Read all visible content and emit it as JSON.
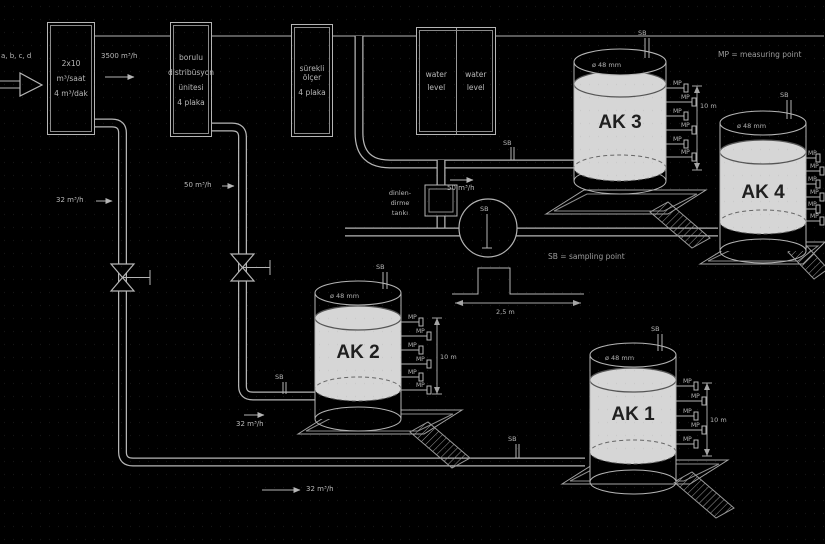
{
  "inlet": {
    "label": "a, b, c, d"
  },
  "process_boxes": {
    "box1": {
      "lines": [
        "2x10",
        "m³/saat",
        "4 m³/dak"
      ]
    },
    "box2": {
      "lines": [
        "borulu",
        "distribüsyon",
        "ünitesi",
        "4 plaka"
      ]
    },
    "box3": {
      "lines": [
        "sürekli ölçer",
        "4 plaka"
      ]
    },
    "box4": {
      "cells": [
        {
          "lines": [
            "water",
            "level"
          ]
        },
        {
          "lines": [
            "water",
            "level"
          ]
        }
      ]
    }
  },
  "flow_labels": {
    "main_feed": "3500 m³/h",
    "left_branch": "32 m³/h",
    "mid_branch": "50 m³/h",
    "settling_feed": "50 m³/h",
    "ak2_feed": "32 m³/h",
    "bottom_line": "32 m³/h"
  },
  "settling_unit": {
    "name_line1": "dinlen-",
    "name_line2": "dirme",
    "name_line3": "tankı",
    "weir_width": "2,5 m"
  },
  "legend": {
    "mp_abbr": "MP",
    "sb_abbr": "SB",
    "mp_definition": "MP = measuring point",
    "sb_definition": "SB = sampling point"
  },
  "tanks": {
    "diameter_label": "ø 48 mm",
    "height_label": "10 m",
    "items": [
      {
        "label": "AK 1"
      },
      {
        "label": "AK 2"
      },
      {
        "label": "AK 3"
      },
      {
        "label": "AK 4"
      }
    ]
  }
}
